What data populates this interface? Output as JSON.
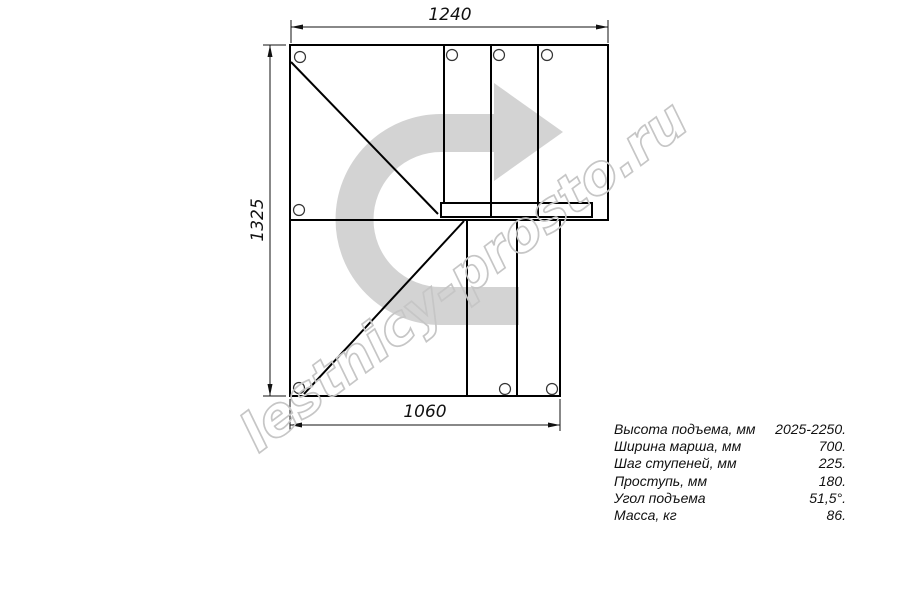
{
  "drawing": {
    "dimensions": {
      "top": "1240",
      "left": "1325",
      "bottom": "1060"
    },
    "watermark": "lestnicy-prosto.ru",
    "colors": {
      "line": "#000000",
      "direction_arrow": "#d3d3d3",
      "watermark": "#c6c6c6"
    }
  },
  "specs": {
    "rows": [
      {
        "label": "Высота подъема, мм",
        "value": "2025-2250."
      },
      {
        "label": "Ширина марша, мм",
        "value": "700."
      },
      {
        "label": "Шаг ступеней, мм",
        "value": "225."
      },
      {
        "label": "Проступь, мм",
        "value": "180."
      },
      {
        "label": "Угол подъема",
        "value": "51,5°."
      },
      {
        "label": "Масса, кг",
        "value": "86."
      }
    ]
  }
}
